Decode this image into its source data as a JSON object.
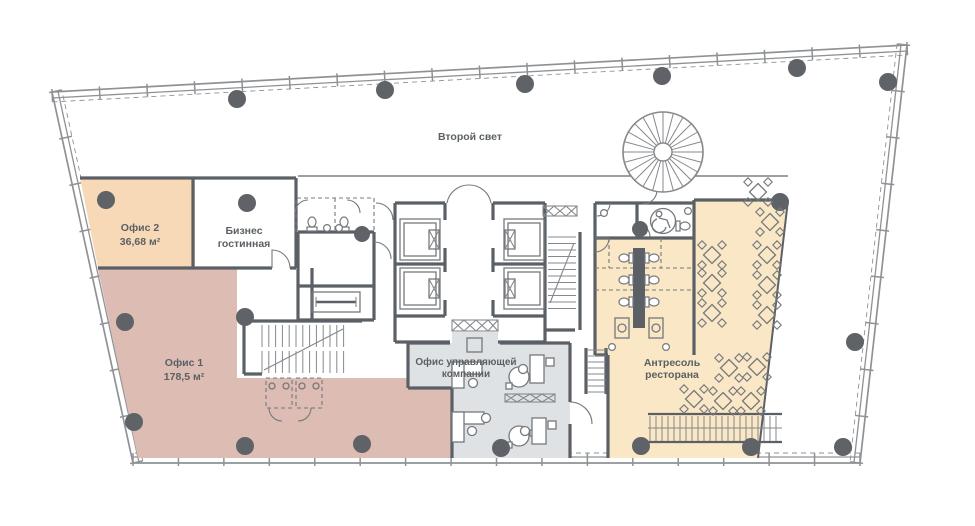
{
  "palette": {
    "wall": "#5b6066",
    "line": "#85888c",
    "furn": "#75787c",
    "column": "#5f6367",
    "label": "#5b6064",
    "envelope": "#8f9295",
    "office2": "#f7d9b8",
    "office1": "#dcbcb3",
    "management": "#dfe2e4",
    "restaurant": "#f9e7c5"
  },
  "rooms": {
    "second_light": {
      "label": "Второй свет"
    },
    "office2": {
      "name": "Офис 2",
      "area": "36,68 м²"
    },
    "lounge": {
      "name_line1": "Бизнес",
      "name_line2": "гостинная"
    },
    "office1": {
      "name": "Офис 1",
      "area": "178,5 м²"
    },
    "management": {
      "name_line1": "Офис управляющей",
      "name_line2": "компании"
    },
    "restaurant_mezzanine": {
      "name_line1": "Антресоль",
      "name_line2": "ресторана"
    }
  },
  "floorplan": {
    "envelope": {
      "edges": [
        {
          "x1": 52,
          "y1": 92,
          "x2": 907,
          "y2": 45,
          "ticks": 18
        },
        {
          "x1": 907,
          "y1": 45,
          "x2": 860,
          "y2": 463,
          "ticks": 9
        },
        {
          "x1": 860,
          "y1": 463,
          "x2": 133,
          "y2": 463,
          "ticks": 16
        },
        {
          "x1": 133,
          "y1": 463,
          "x2": 52,
          "y2": 92,
          "ticks": 8
        }
      ]
    },
    "columns": [
      [
        237,
        99,
        9
      ],
      [
        385,
        90,
        9
      ],
      [
        525,
        84,
        9
      ],
      [
        662,
        76,
        9
      ],
      [
        797,
        68,
        9
      ],
      [
        888,
        82,
        9
      ],
      [
        855,
        342,
        9
      ],
      [
        843,
        447,
        9
      ],
      [
        751,
        447,
        9
      ],
      [
        641,
        446,
        9
      ],
      [
        501,
        448,
        9
      ],
      [
        362,
        444,
        9
      ],
      [
        245,
        446,
        9
      ],
      [
        134,
        422,
        9
      ],
      [
        125,
        322,
        9
      ],
      [
        106,
        200,
        9
      ],
      [
        247,
        203,
        9
      ],
      [
        780,
        202,
        9
      ],
      [
        245,
        317,
        9
      ],
      [
        362,
        234,
        8
      ],
      [
        640,
        229,
        8
      ]
    ],
    "tables": [
      [
        758,
        192
      ],
      [
        770,
        222
      ],
      [
        712,
        255
      ],
      [
        767,
        255
      ],
      [
        712,
        283
      ],
      [
        767,
        285
      ],
      [
        712,
        313
      ],
      [
        767,
        315
      ],
      [
        729,
        368
      ],
      [
        757,
        367
      ],
      [
        694,
        399
      ],
      [
        723,
        401
      ],
      [
        751,
        401
      ]
    ],
    "stairs": [
      {
        "x": 548,
        "y": 237,
        "w": 28,
        "h": 72,
        "axis": "rows",
        "step": 6.5
      },
      {
        "x": 262,
        "y": 325,
        "w": 83,
        "h": 22,
        "axis": "cols",
        "step": 6.8
      },
      {
        "x": 262,
        "y": 351,
        "w": 83,
        "h": 22,
        "axis": "cols",
        "step": 6.8
      },
      {
        "x": 650,
        "y": 416,
        "w": 131,
        "h": 25,
        "axis": "cols",
        "step": 6
      },
      {
        "x": 588,
        "y": 350,
        "w": 18,
        "h": 44,
        "axis": "rows",
        "step": 6
      }
    ],
    "spiral": {
      "cx": 663,
      "cy": 152,
      "r": 40,
      "r2": 9,
      "spokes": 24
    },
    "toilets": [
      [
        312,
        223,
        180
      ],
      [
        344,
        223,
        180
      ],
      [
        625,
        258,
        90
      ],
      [
        625,
        280,
        90
      ],
      [
        625,
        302,
        90
      ],
      [
        653,
        258,
        -90
      ],
      [
        653,
        280,
        -90
      ],
      [
        653,
        302,
        -90
      ],
      [
        684,
        226,
        -90
      ]
    ],
    "sinks": [
      [
        327,
        228
      ],
      [
        339,
        228
      ],
      [
        604,
        213
      ],
      [
        688,
        211
      ],
      [
        612,
        347
      ],
      [
        666,
        347
      ]
    ]
  }
}
